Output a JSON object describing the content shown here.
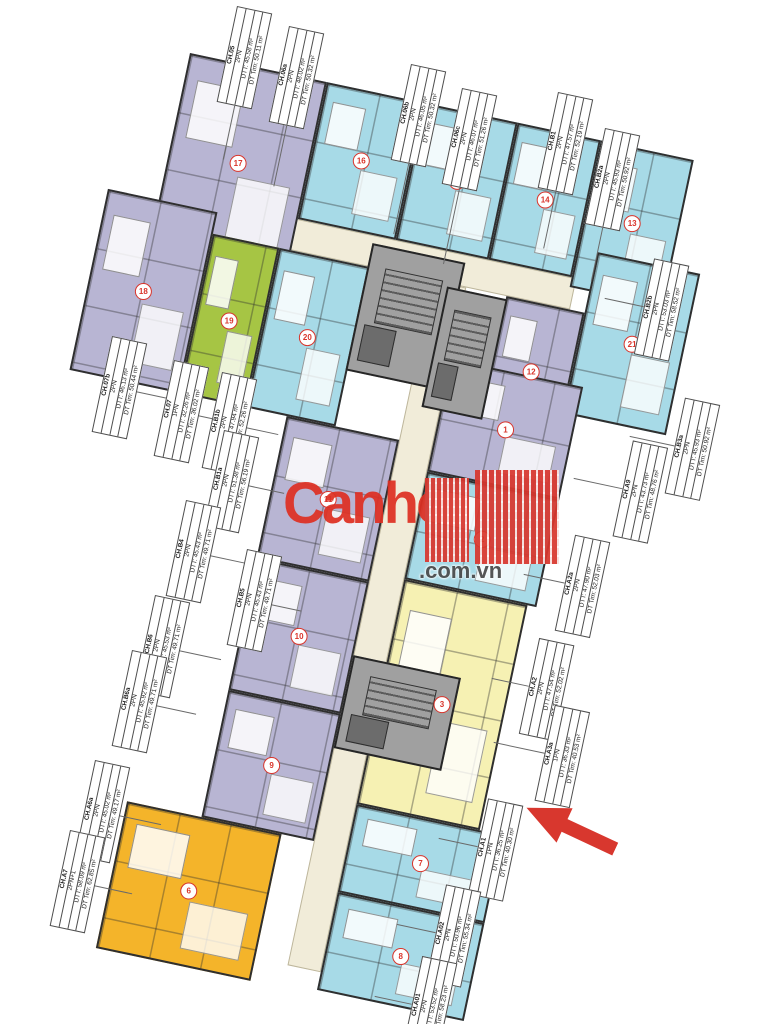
{
  "palette": {
    "cyan": "#a7dae7",
    "lavender": "#b8b5d3",
    "green": "#a6c544",
    "yellow": "#f6f1b3",
    "orange": "#f4b42a",
    "core": "#a0a0a0",
    "corridor": "#f1ecd9",
    "wall": "#2f2f2f",
    "badge_red": "#d9342b",
    "arrow_red": "#d8372e",
    "watermark_red": "#de3023"
  },
  "plan": {
    "origin_x": 190,
    "origin_y": 53,
    "angle_deg": 12
  },
  "corridors": [
    {
      "x": 35,
      "y": 140,
      "w": 390,
      "h": 32
    },
    {
      "x": 285,
      "y": 172,
      "w": 34,
      "h": 700
    }
  ],
  "cores": [
    {
      "x": 218,
      "y": 148,
      "w": 95,
      "h": 130
    },
    {
      "x": 300,
      "y": 175,
      "w": 62,
      "h": 123
    },
    {
      "x": 285,
      "y": 555,
      "w": 110,
      "h": 95
    }
  ],
  "units": [
    {
      "id": "u01",
      "color": "lavender",
      "x": 0,
      "y": 0,
      "w": 140,
      "h": 195,
      "badge": "17"
    },
    {
      "id": "u02",
      "color": "cyan",
      "x": 140,
      "y": 0,
      "w": 100,
      "h": 140,
      "badge": "16"
    },
    {
      "id": "u03",
      "color": "cyan",
      "x": 240,
      "y": 0,
      "w": 95,
      "h": 140,
      "badge": "15"
    },
    {
      "id": "u04",
      "color": "cyan",
      "x": 335,
      "y": 0,
      "w": 85,
      "h": 140,
      "badge": "14"
    },
    {
      "id": "u05",
      "color": "cyan",
      "x": 420,
      "y": 0,
      "w": 95,
      "h": 150,
      "badge": "13"
    },
    {
      "id": "u06",
      "color": "lavender",
      "x": -52,
      "y": 150,
      "w": 112,
      "h": 185,
      "badge": "18"
    },
    {
      "id": "u07",
      "color": "green",
      "x": 60,
      "y": 172,
      "w": 68,
      "h": 163,
      "badge": "19"
    },
    {
      "id": "u08",
      "color": "cyan",
      "x": 128,
      "y": 172,
      "w": 92,
      "h": 163,
      "badge": "20"
    },
    {
      "id": "u09",
      "color": "lavender",
      "x": 360,
      "y": 172,
      "w": 80,
      "h": 138,
      "badge": "12"
    },
    {
      "id": "u10",
      "color": "cyan",
      "x": 440,
      "y": 110,
      "w": 105,
      "h": 165,
      "badge": "21"
    },
    {
      "id": "u11",
      "color": "lavender",
      "x": 319,
      "y": 245,
      "w": 135,
      "h": 115,
      "badge": "1"
    },
    {
      "id": "u12",
      "color": "cyan",
      "x": 319,
      "y": 360,
      "w": 135,
      "h": 110,
      "badge": "2"
    },
    {
      "id": "u13",
      "color": "yellow",
      "x": 319,
      "y": 470,
      "w": 126,
      "h": 230,
      "badge": "3"
    },
    {
      "id": "u14",
      "color": "cyan",
      "x": 319,
      "y": 700,
      "w": 150,
      "h": 90,
      "badge": "7"
    },
    {
      "id": "u15",
      "color": "cyan",
      "x": 319,
      "y": 790,
      "w": 150,
      "h": 100,
      "badge": "8"
    },
    {
      "id": "u16",
      "color": "lavender",
      "x": 170,
      "y": 335,
      "w": 115,
      "h": 145,
      "badge": "11"
    },
    {
      "id": "u17",
      "color": "lavender",
      "x": 170,
      "y": 480,
      "w": 115,
      "h": 135,
      "badge": "10"
    },
    {
      "id": "u18",
      "color": "lavender",
      "x": 170,
      "y": 615,
      "w": 115,
      "h": 130,
      "badge": "9"
    },
    {
      "id": "u19",
      "color": "orange",
      "x": 94,
      "y": 745,
      "w": 158,
      "h": 150,
      "badge": "6"
    }
  ],
  "tags": [
    {
      "code": "CH.05",
      "pn": "2PN",
      "dtt": "DTT: 45.58 m²",
      "dttim": "DT Tim: 50.11 m²",
      "x": 237,
      "y": 6,
      "side": "top",
      "leader": 55
    },
    {
      "code": "CH.06a",
      "pn": "2PN",
      "dtt": "DTT: 48.02 m²",
      "dttim": "DT Tim: 50.32 m²",
      "x": 289,
      "y": 26,
      "side": "top",
      "leader": 62
    },
    {
      "code": "CH.06b",
      "pn": "2PN",
      "dtt": "DTT: 46.05 m²",
      "dttim": "DT Tim: 50.32 m²",
      "x": 411,
      "y": 64,
      "side": "top",
      "leader": 72
    },
    {
      "code": "CH.06c",
      "pn": "2PN",
      "dtt": "DTT: 46.07 m²",
      "dttim": "DT Tim: 51.26 m²",
      "x": 462,
      "y": 88,
      "side": "top",
      "leader": 78
    },
    {
      "code": "CH.B1",
      "pn": "2PN",
      "dtt": "DTT: 47.57 m²",
      "dttim": "DT Tim: 52.19 m²",
      "x": 558,
      "y": 92,
      "side": "top",
      "leader": 58
    },
    {
      "code": "CH.B2a",
      "pn": "2PN",
      "dtt": "DTT: 45.93 m²",
      "dttim": "DT Tim: 50.92 m²",
      "x": 605,
      "y": 128,
      "side": "top",
      "leader": 55
    },
    {
      "code": "CH.B2b",
      "pn": "2PN",
      "dtt": "DTT: 53.03 m²",
      "dttim": "DT Tim: 58.52 m²",
      "x": 655,
      "y": 250,
      "side": "right",
      "leader": 40
    },
    {
      "code": "CH.B3a",
      "pn": "2PN",
      "dtt": "DTT: 45.93 m²",
      "dttim": "DT Tim: 50.92 m²",
      "x": 686,
      "y": 388,
      "side": "right",
      "leader": 46
    },
    {
      "code": "CH.A9",
      "pn": "2PN",
      "dtt": "DTT: 43.73 m²",
      "dttim": "DT Tim: 48.76 m²",
      "x": 634,
      "y": 430,
      "side": "right",
      "leader": 50
    },
    {
      "code": "CH.A2a",
      "pn": "2PN",
      "dtt": "DTT: 47.90 m²",
      "dttim": "DT Tim: 52.03 m²",
      "x": 576,
      "y": 526,
      "side": "right",
      "leader": 42
    },
    {
      "code": "CH.A2",
      "pn": "2PN",
      "dtt": "DTT: 47.54 m²",
      "dttim": "DT Tim: 52.02 m²",
      "x": 540,
      "y": 630,
      "side": "right",
      "leader": 38
    },
    {
      "code": "CH.A3a",
      "pn": "1PN",
      "dtt": "DTT: 36.33 m²",
      "dttim": "DT Tim: 40.53 m²",
      "x": 556,
      "y": 694,
      "side": "right",
      "leader": 52
    },
    {
      "code": "CH.A1",
      "pn": "1PN",
      "dtt": "DTT: 36.25 m²",
      "dttim": "DT Tim: 40.30 m²",
      "x": 489,
      "y": 790,
      "side": "right",
      "leader": 40
    },
    {
      "code": "CH.A02",
      "pn": "2PN",
      "dtt": "DTT: 50.96 m²",
      "dttim": "DT Tim: 55.34 m²",
      "x": 447,
      "y": 876,
      "side": "right",
      "leader": 40
    },
    {
      "code": "CH.A01",
      "pn": "2PN",
      "dtt": "DTT: 53.52 m²",
      "dttim": "DT Tim: 58.23 m²",
      "x": 423,
      "y": 948,
      "side": "right",
      "leader": 38
    },
    {
      "code": "CH.07b",
      "pn": "2PN",
      "dtt": "DTT: 46.13 m²",
      "dttim": "DT Tim: 50.44 m²",
      "x": 112,
      "y": 336,
      "side": "left",
      "leader": 36
    },
    {
      "code": "CH.07",
      "pn": "1PN",
      "dtt": "DTT: 32.26 m²",
      "dttim": "DT Tim: 36.02 m²",
      "x": 174,
      "y": 360,
      "side": "left",
      "leader": 30
    },
    {
      "code": "CH.B1b",
      "pn": "2PN",
      "dtt": "DTT: 47.94 m²",
      "dttim": "DT Tim: 52.26 m²",
      "x": 222,
      "y": 372,
      "side": "left",
      "leader": 32
    },
    {
      "code": "CH.B1a",
      "pn": "2PN",
      "dtt": "DTT: 51.38 m²",
      "dttim": "DT Tim: 56.19 m²",
      "x": 224,
      "y": 430,
      "side": "left",
      "leader": 36
    },
    {
      "code": "CH.B4",
      "pn": "2PN",
      "dtt": "DTT: 45.43 m²",
      "dttim": "DT Tim: 49.71 m²",
      "x": 186,
      "y": 500,
      "side": "left",
      "leader": 38
    },
    {
      "code": "CH.B5",
      "pn": "2PN",
      "dtt": "DTT: 45.43 m²",
      "dttim": "DT Tim: 49.71 m²",
      "x": 247,
      "y": 549,
      "side": "left",
      "leader": 30
    },
    {
      "code": "CH.B6",
      "pn": "2PN",
      "dtt": "DTT: 45.53 m²",
      "dttim": "DT Tim: 49.71 m²",
      "x": 155,
      "y": 595,
      "side": "left",
      "leader": 42
    },
    {
      "code": "CH.B6a",
      "pn": "2PN",
      "dtt": "DTT: 45.92 m²",
      "dttim": "DT Tim: 49.71 m²",
      "x": 132,
      "y": 650,
      "side": "left",
      "leader": 40
    },
    {
      "code": "CH.A6a",
      "pn": "2PN",
      "dtt": "DTT: 45.02 m²",
      "dttim": "DT Tim: 49.17 m²",
      "x": 95,
      "y": 760,
      "side": "left",
      "leader": 42
    },
    {
      "code": "CH.A7",
      "pn": "2PN+1",
      "dtt": "DTT: 58.09 m²",
      "dttim": "DT Tim: 62.85 m²",
      "x": 70,
      "y": 830,
      "side": "left",
      "leader": 38
    }
  ],
  "watermark": {
    "brand": "Canho",
    "suffix": ".com.vn"
  },
  "arrow": {
    "x": 520,
    "y": 808,
    "rotation_deg": 205,
    "points_to": "CH.A1"
  }
}
